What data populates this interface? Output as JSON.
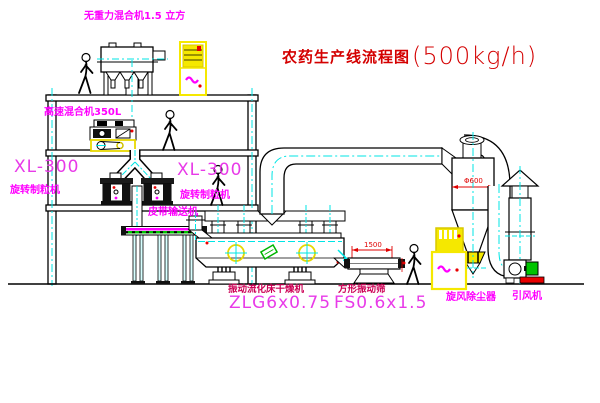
{
  "title": {
    "text": "农药生产线流程图",
    "capacity": "(500kg/h)"
  },
  "equipment_labels": {
    "weightless_mixer": "无重力混合机1.5 立方",
    "high_speed_mixer": "高速混合机350L",
    "granulator_left_model": "XL-300",
    "granulator_left_name": "旋转制粒机",
    "granulator_mid_model": "XL-300",
    "granulator_mid_name": "旋转制粒机",
    "belt_conveyor": "皮带输送机",
    "fluid_bed_dryer_name": "振动流化床干燥机",
    "fluid_bed_dryer_model": "ZLG6x0.75",
    "square_sieve_name": "方形振动筛",
    "square_sieve_model": "FS0.6x1.5",
    "cyclone_collector": "旋风除尘器",
    "induced_draft_fan": "引风机"
  },
  "dimensions": {
    "cyclone_diameter": "Φ600",
    "sieve_length": "1500"
  },
  "colors": {
    "line_black": "#000000",
    "centerline_cyan": "#00e5e5",
    "label_magenta": "#ff00ff",
    "dark_label_red": "#cc0055",
    "title_red": "#d40000",
    "cabinet_yellow": "#f5e800",
    "accent_red": "#e80000",
    "motor_green": "#00c400"
  }
}
